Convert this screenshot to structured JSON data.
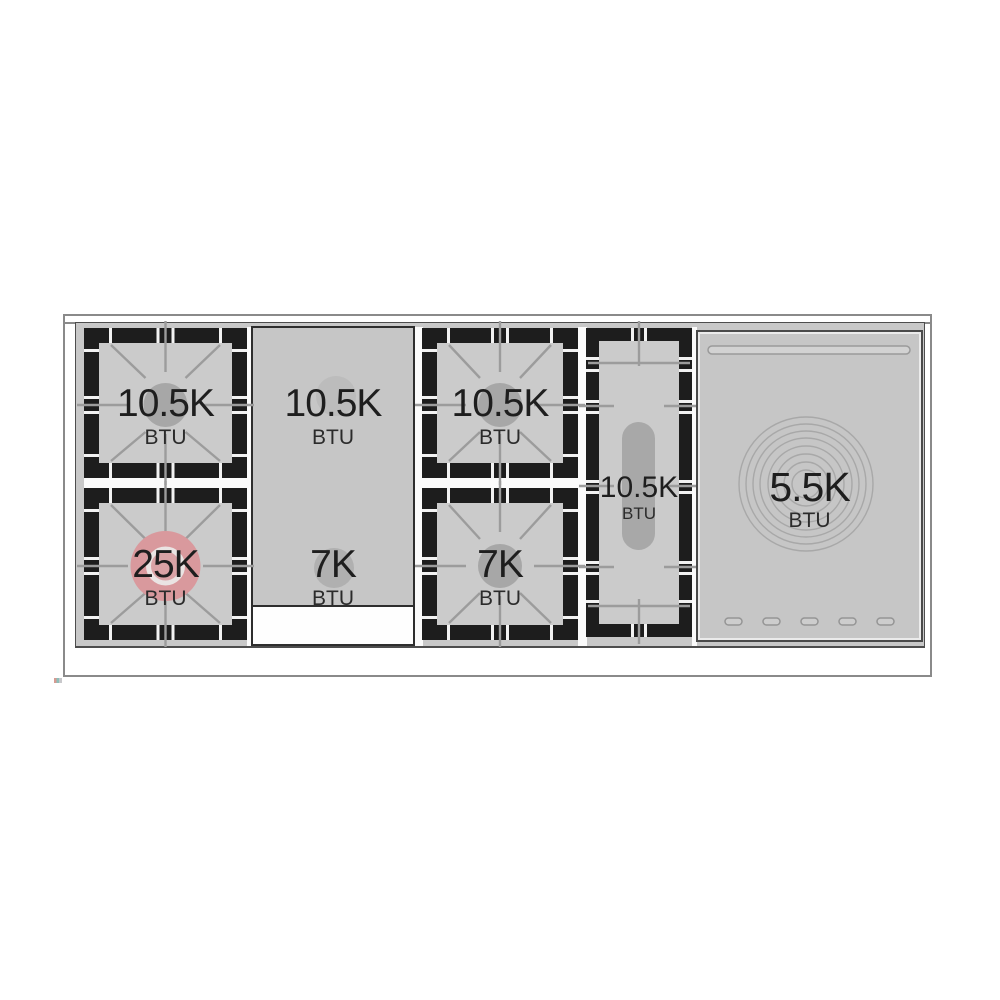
{
  "diagram": {
    "kind": "range-cooktop-top-view",
    "surface_color": "#c8c8c8",
    "grate_color": "#1d1d1d",
    "accent_pink": "#d9999d",
    "burners": [
      {
        "id": "left-rear",
        "value": "10.5K",
        "unit": "BTU",
        "type": "sealed-burner",
        "highlighted": false
      },
      {
        "id": "left-front",
        "value": "25K",
        "unit": "BTU",
        "type": "sealed-burner",
        "highlighted": true
      },
      {
        "id": "griddle-rear",
        "value": "10.5K",
        "unit": "BTU",
        "type": "griddle-burner",
        "highlighted": false
      },
      {
        "id": "griddle-front",
        "value": "7K",
        "unit": "BTU",
        "type": "griddle-burner",
        "highlighted": false
      },
      {
        "id": "center-rear",
        "value": "10.5K",
        "unit": "BTU",
        "type": "sealed-burner",
        "highlighted": false
      },
      {
        "id": "center-front",
        "value": "7K",
        "unit": "BTU",
        "type": "sealed-burner",
        "highlighted": false
      },
      {
        "id": "oval-center",
        "value": "10.5K",
        "unit": "BTU",
        "type": "oval-burner",
        "highlighted": false
      },
      {
        "id": "simmer-plate",
        "value": "5.5K",
        "unit": "BTU",
        "type": "simmer-plate",
        "highlighted": false
      }
    ]
  }
}
